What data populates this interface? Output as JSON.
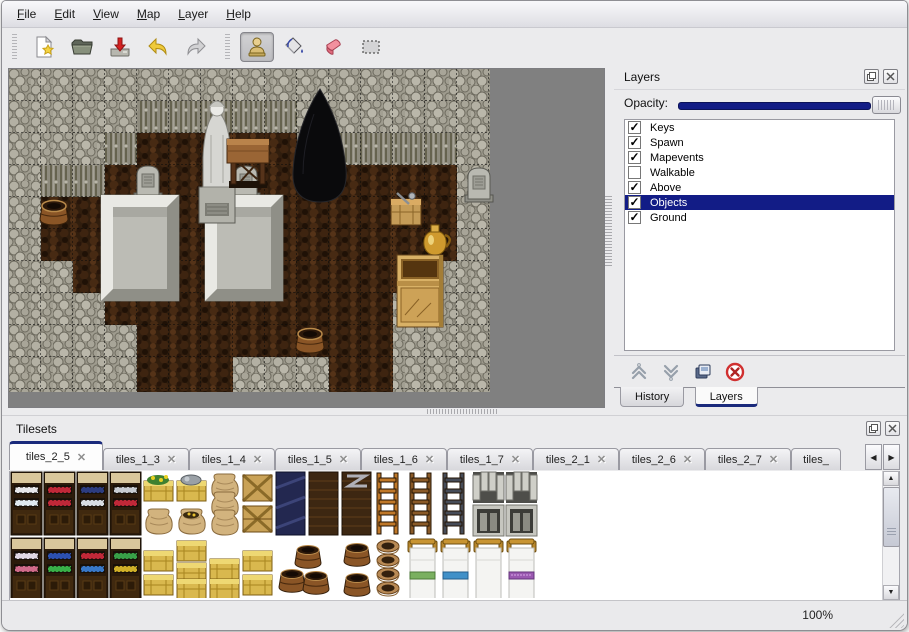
{
  "menu_bar": {
    "items": [
      "File",
      "Edit",
      "View",
      "Map",
      "Layer",
      "Help"
    ]
  },
  "toolbar": {
    "buttons": [
      {
        "icon": "new-file-icon",
        "active": false
      },
      {
        "icon": "open-folder-icon",
        "active": false
      },
      {
        "icon": "save-icon",
        "active": false
      },
      {
        "icon": "undo-icon",
        "active": false
      },
      {
        "icon": "redo-icon",
        "active": false
      },
      {
        "icon": "stamp-tool-icon",
        "active": true
      },
      {
        "icon": "fill-tool-icon",
        "active": false
      },
      {
        "icon": "eraser-tool-icon",
        "active": false
      },
      {
        "icon": "select-tool-icon",
        "active": false
      }
    ]
  },
  "map_view": {
    "objects": [
      "rock-wall",
      "cave-floor",
      "cave-entrance",
      "statue",
      "wooden-table",
      "gravestone-left",
      "gravestone-right",
      "gravestone-far-right",
      "stone-platform-left",
      "stone-platform-right",
      "barrel-left",
      "barrel-bottom",
      "crate-with-tools",
      "gold-jug",
      "wooden-cabinet"
    ]
  },
  "layers_panel": {
    "title": "Layers",
    "opacity_label": "Opacity:",
    "check_glyph": "✓",
    "layers": [
      {
        "label": "Keys",
        "checked": true,
        "selected": false
      },
      {
        "label": "Spawn",
        "checked": true,
        "selected": false
      },
      {
        "label": "Mapevents",
        "checked": true,
        "selected": false
      },
      {
        "label": "Walkable",
        "checked": false,
        "selected": false
      },
      {
        "label": "Above",
        "checked": true,
        "selected": false
      },
      {
        "label": "Objects",
        "checked": true,
        "selected": true
      },
      {
        "label": "Ground",
        "checked": true,
        "selected": false
      }
    ],
    "buttons": [
      {
        "icon": "move-layer-up-icon"
      },
      {
        "icon": "move-layer-down-icon"
      },
      {
        "icon": "duplicate-layer-icon"
      },
      {
        "icon": "delete-layer-icon"
      }
    ],
    "tabs": [
      {
        "label": "History",
        "active": false
      },
      {
        "label": "Layers",
        "active": true
      }
    ]
  },
  "tilesets_panel": {
    "title": "Tilesets",
    "close_glyph": "✕",
    "tabs": [
      {
        "label": "tiles_2_5",
        "active": true
      },
      {
        "label": "tiles_1_3",
        "active": false
      },
      {
        "label": "tiles_1_4",
        "active": false
      },
      {
        "label": "tiles_1_5",
        "active": false
      },
      {
        "label": "tiles_1_6",
        "active": false
      },
      {
        "label": "tiles_1_7",
        "active": false
      },
      {
        "label": "tiles_2_1",
        "active": false
      },
      {
        "label": "tiles_2_6",
        "active": false
      },
      {
        "label": "tiles_2_7",
        "active": false
      },
      {
        "label": "tiles_",
        "active": false
      }
    ],
    "tiles": [
      "shelf-dishes",
      "shelf-red-bottles",
      "shelf-blue-dishes",
      "shelf-kettles",
      "flower-crate",
      "burlap-sack",
      "supply-crate",
      "open-gold-sack",
      "sack-stack",
      "crossed-crate",
      "plank-crate",
      "navy-crate",
      "dark-dresser",
      "metal-banded-chest",
      "ladder-orange",
      "ladder-brown",
      "ladder-steel",
      "stone-arch-left",
      "stone-arch-right",
      "stone-door-left",
      "stone-door-right",
      "shelf-jars",
      "shelf-blue-books",
      "shelf-red-books",
      "shelf-bottles",
      "yellow-crate-stack-1",
      "yellow-crate-stack-2",
      "yellow-crate-stack-3",
      "yellow-crate-stack-4",
      "barrel-pile",
      "barrels-two",
      "pot-stack",
      "bed-green",
      "bed-blue",
      "bed-white",
      "bed-purple"
    ]
  },
  "glyphs": {
    "up": "▲",
    "down": "▼",
    "left": "◀",
    "right": "▶"
  },
  "status_bar": {
    "zoom_level": "100%"
  }
}
